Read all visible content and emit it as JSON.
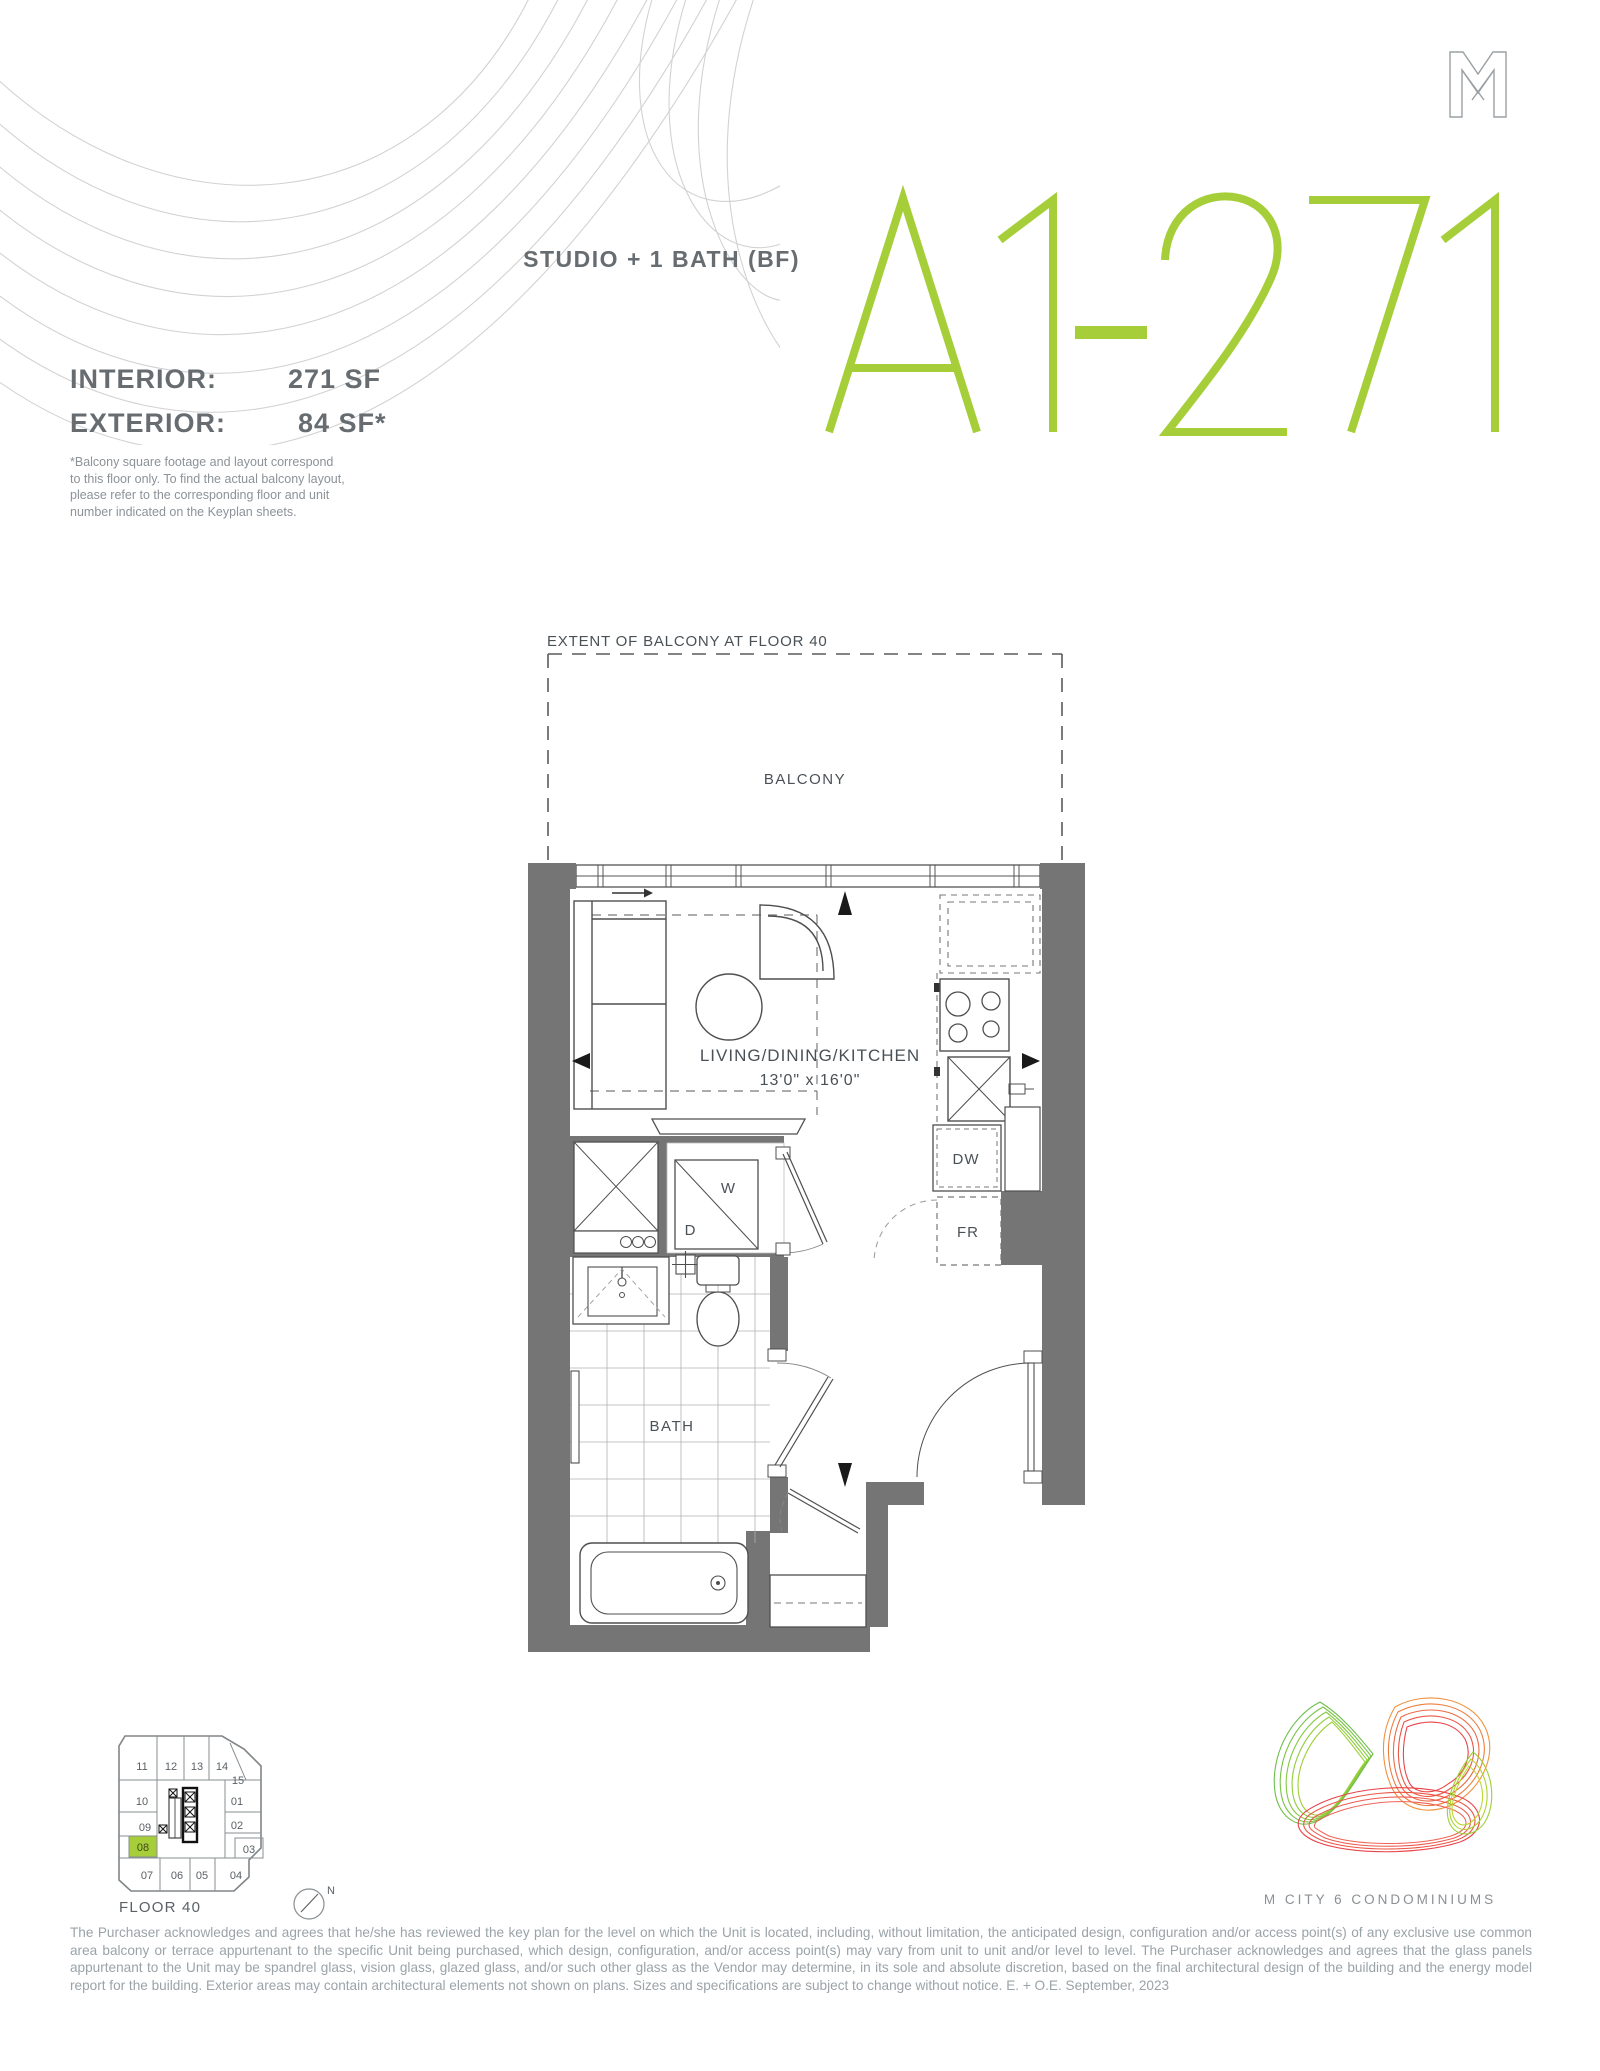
{
  "header": {
    "unit_type": "STUDIO + 1 BATH (BF)",
    "unit_code": "A1-271",
    "specs": [
      {
        "label": "INTERIOR:",
        "value": "271 SF"
      },
      {
        "label": "EXTERIOR:",
        "value": "84 SF*"
      }
    ],
    "footnote_lines": [
      "*Balcony square footage and layout correspond",
      "to this floor only. To find the actual balcony layout,",
      "please refer to the corresponding floor and unit",
      "number indicated on the Keyplan sheets."
    ]
  },
  "plan": {
    "balcony_extent_label": "EXTENT OF BALCONY AT FLOOR 40",
    "balcony_label": "BALCONY",
    "living_label": "LIVING/DINING/KITCHEN",
    "living_dims": "13'0\" x 16'0\"",
    "bath_label": "BATH",
    "washer_label": "W",
    "dryer_label": "D",
    "dishwasher_label": "DW",
    "fridge_label": "FR"
  },
  "keyplan": {
    "floor_label": "FLOOR 40",
    "north_label": "N",
    "highlighted_unit": "08",
    "units": [
      "11",
      "12",
      "13",
      "14",
      "15",
      "10",
      "01",
      "09",
      "02",
      "08",
      "03",
      "07",
      "06",
      "05",
      "04"
    ]
  },
  "footer": {
    "brand": "M CITY 6 CONDOMINIUMS",
    "legal": "The Purchaser acknowledges and agrees that he/she has reviewed the key plan for the level on which the Unit is located, including, without limitation, the anticipated design, configuration and/or access point(s) of any exclusive use common area balcony or terrace appurtenant to the specific Unit being purchased, which design, configuration, and/or access point(s) may vary from unit to unit and/or level to level. The Purchaser acknowledges and agrees that the glass panels appurtenant to the Unit may be spandrel glass, vision glass, glazed glass, and/or such other glass as the Vendor may determine, in its sole and absolute discretion, based on the final architectural design of the building and the energy model report for the building. Exterior areas may contain architectural elements not shown on plans. Sizes and specifications are subject to change without notice. E. + O.E. September, 2023"
  },
  "colors": {
    "accent_green": "#a6ce39",
    "wall_gray": "#757575",
    "line_gray": "#4f4f4f",
    "heading_gray": "#666c70",
    "legal_gray": "#9aa3a8"
  }
}
